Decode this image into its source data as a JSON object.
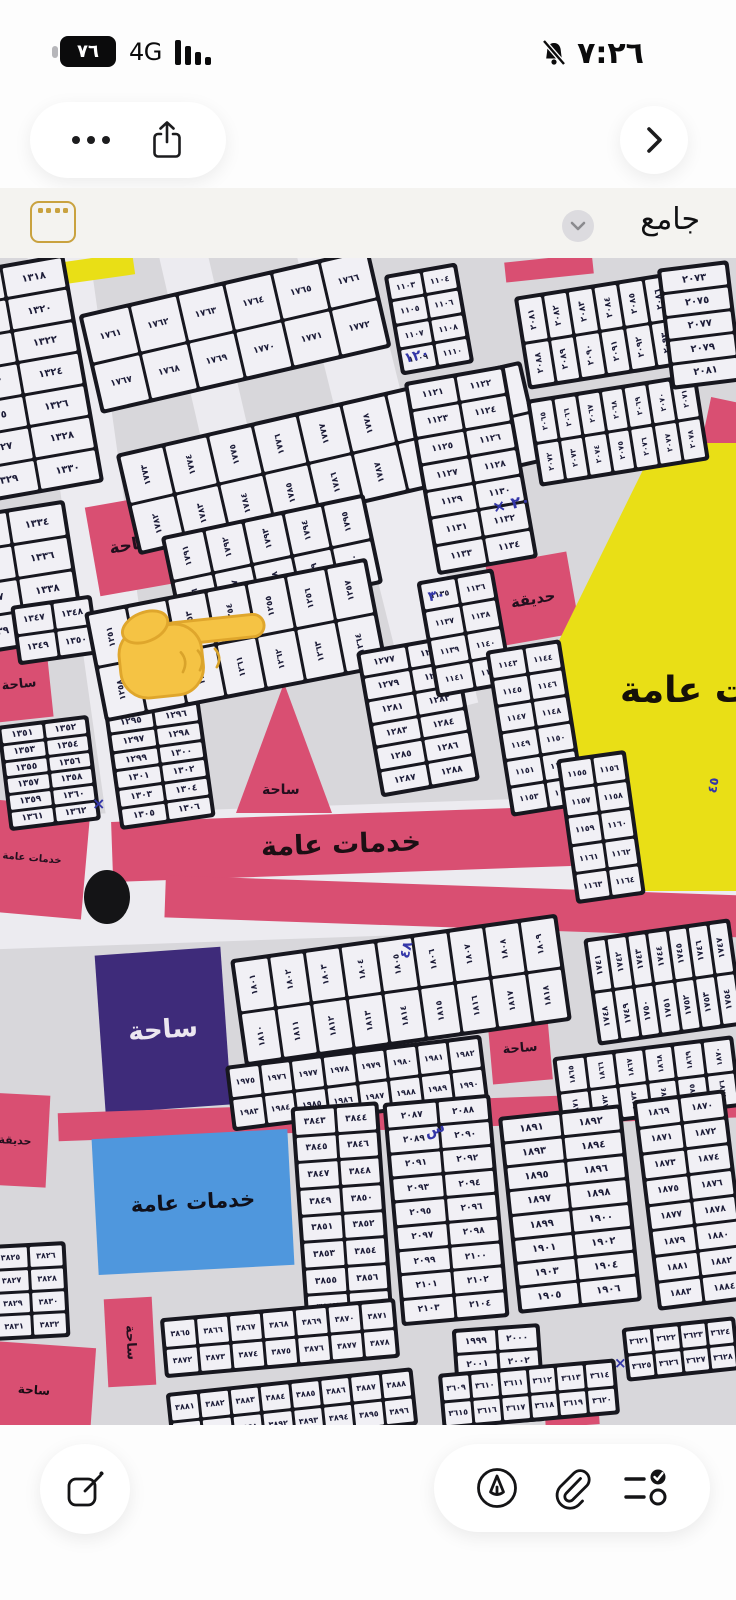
{
  "status_bar": {
    "battery_percent": "٧٦",
    "network": "4G",
    "time": "٧:٢٦"
  },
  "title_bar": {
    "title": "جامع"
  },
  "icons": {
    "more": "ellipsis",
    "share": "square-arrow-up",
    "back": "chevron-right",
    "thumbnail": "gold-card",
    "title_chevron": "chevron-down",
    "compose": "square-pencil",
    "markup": "pen-in-circle",
    "attach": "paperclip",
    "checklist": "list-check",
    "muted": "bell-slash"
  },
  "colors": {
    "pink": "#d94f72",
    "yellow": "#e9df16",
    "purple": "#3e2b7a",
    "blue": "#4f97dd",
    "paper": "#d8d7db",
    "road": "#ecebf0",
    "block": "#17171f",
    "cell": "#f1f0f5",
    "ink": "#1c1c38",
    "pen_blue": "#3336a8",
    "gold": "#c9a23f"
  },
  "map": {
    "roads": [
      {
        "x": 70,
        "y": -30,
        "w": 62,
        "h": 660,
        "r": -8
      },
      {
        "x": 352,
        "y": -30,
        "w": 68,
        "h": 490,
        "r": -14
      },
      {
        "x": -30,
        "y": 546,
        "w": 810,
        "h": 132,
        "r": -2
      },
      {
        "x": 190,
        "y": -20,
        "w": 48,
        "h": 300,
        "r": -13
      }
    ],
    "zones": [
      {
        "n": "yellow-wedge-top",
        "x": 52,
        "y": 0,
        "w": 82,
        "h": 22,
        "r": -8,
        "c": "#e9df16"
      },
      {
        "n": "pink-sliver-top",
        "x": 505,
        "y": 0,
        "w": 88,
        "h": 20,
        "r": -6,
        "c": "#d94f72"
      },
      {
        "n": "pink-sliver-right",
        "x": 706,
        "y": 142,
        "w": 34,
        "h": 46,
        "r": 12,
        "c": "#d94f72"
      },
      {
        "n": "zone-saha-square",
        "x": 92,
        "y": 242,
        "w": 80,
        "h": 90,
        "r": -10,
        "c": "#d94f72",
        "label": "ساحة",
        "fs": 17,
        "tc": "#230f1e"
      },
      {
        "n": "zone-saha-left",
        "x": -12,
        "y": 390,
        "w": 62,
        "h": 72,
        "r": -6,
        "c": "#d94f72",
        "label": "ساحة",
        "fs": 13,
        "tc": "#230f1e"
      },
      {
        "n": "zone-hadiqa-mid",
        "x": 492,
        "y": 300,
        "w": 82,
        "h": 82,
        "r": -10,
        "c": "#d94f72",
        "label": "حديقة",
        "fs": 15,
        "tc": "#230f1e"
      },
      {
        "n": "zone-yellow-services",
        "x": 546,
        "y": 185,
        "w": 190,
        "h": 448,
        "c": "#e9df16",
        "clip": "polygon(58% 0,100% 0,100% 100%,26% 100%,0 50%)",
        "label": "خدمات عامة",
        "fs": 36,
        "tc": "#151008",
        "lx": 74,
        "ly": 230
      },
      {
        "n": "zone-saha-triangle",
        "x": 236,
        "y": 425,
        "w": 96,
        "h": 130,
        "c": "#d94f72",
        "clip": "polygon(50% 0,100% 100%,0 100%)",
        "label": "ساحة",
        "fs": 14,
        "tc": "#230f1e",
        "lx": 26,
        "ly": 100
      },
      {
        "n": "zone-services-strip",
        "x": 112,
        "y": 556,
        "w": 458,
        "h": 60,
        "r": -2,
        "c": "#d94f72",
        "label": "خدمات عامة",
        "fs": 27,
        "tc": "#1c0f14"
      },
      {
        "n": "zone-road-strip2",
        "x": 165,
        "y": 628,
        "w": 610,
        "h": 42,
        "r": 2,
        "c": "#d94f72"
      },
      {
        "n": "zone-services-left-small",
        "x": -22,
        "y": 545,
        "w": 108,
        "h": 112,
        "r": 5,
        "c": "#d94f72",
        "label": "خدمات عامة",
        "fs": 10,
        "tc": "#230f1e"
      },
      {
        "n": "zone-saha-purple",
        "x": 100,
        "y": 693,
        "w": 126,
        "h": 158,
        "r": -4,
        "c": "#3e2b7a",
        "label": "ساحة",
        "fs": 26,
        "tc": "#ece7f0"
      },
      {
        "n": "zone-saha-small-square",
        "x": 490,
        "y": 756,
        "w": 60,
        "h": 68,
        "r": -5,
        "c": "#d94f72",
        "label": "ساحة",
        "fs": 13,
        "tc": "#230f1e"
      },
      {
        "n": "zone-pink-band-lower",
        "x": 58,
        "y": 843,
        "w": 700,
        "h": 28,
        "r": -2,
        "c": "#d94f72"
      },
      {
        "n": "zone-hadiqa-left",
        "x": -18,
        "y": 836,
        "w": 66,
        "h": 92,
        "r": 3,
        "c": "#d94f72",
        "label": "حديقة",
        "fs": 11,
        "tc": "#230f1e"
      },
      {
        "n": "zone-services-blue",
        "x": 95,
        "y": 876,
        "w": 196,
        "h": 136,
        "r": -3,
        "c": "#4f97dd",
        "label": "خدمات عامة",
        "fs": 21,
        "tc": "#10101a"
      },
      {
        "n": "zone-saha-vrect",
        "x": 106,
        "y": 1040,
        "w": 48,
        "h": 88,
        "r": -3,
        "c": "#d94f72",
        "label": "ساحة",
        "fs": 13,
        "tc": "#230f1e",
        "vert": true
      },
      {
        "n": "zone-pink-bottomleft",
        "x": -25,
        "y": 1086,
        "w": 118,
        "h": 92,
        "r": 4,
        "c": "#d94f72",
        "label": "ساحة",
        "fs": 12,
        "tc": "#1a0c14"
      },
      {
        "n": "zone-hadiqa-bottomright",
        "x": 544,
        "y": 1118,
        "w": 54,
        "h": 50,
        "r": -4,
        "c": "#d94f72",
        "label": "حديقة",
        "fs": 9,
        "tc": "#230f1e"
      }
    ],
    "blocks": [
      {
        "x": -45,
        "y": 5,
        "w": 130,
        "h": 232,
        "r": -10,
        "rows": 7,
        "cols": 2,
        "start": 1317
      },
      {
        "x": -42,
        "y": 250,
        "w": 118,
        "h": 140,
        "r": -9,
        "rows": 4,
        "cols": 2,
        "start": 1333
      },
      {
        "x": 14,
        "y": 342,
        "w": 82,
        "h": 60,
        "r": -8,
        "rows": 2,
        "cols": 2,
        "start": 1347
      },
      {
        "x": 3,
        "y": 462,
        "w": 92,
        "h": 106,
        "r": -7,
        "rows": 6,
        "cols": 2,
        "start": 1351
      },
      {
        "x": 112,
        "y": 448,
        "w": 96,
        "h": 118,
        "r": -8,
        "rows": 6,
        "cols": 2,
        "start": 1295
      },
      {
        "x": 86,
        "y": 22,
        "w": 298,
        "h": 102,
        "r": -13,
        "rows": 2,
        "cols": 6,
        "start": 1761
      },
      {
        "x": 122,
        "y": 148,
        "w": 416,
        "h": 104,
        "r": -13,
        "rows": 2,
        "cols": 9,
        "start": 1773
      },
      {
        "x": 168,
        "y": 256,
        "w": 208,
        "h": 92,
        "r": -12,
        "rows": 2,
        "cols": 5,
        "start": 1791
      },
      {
        "x": 92,
        "y": 326,
        "w": 288,
        "h": 112,
        "r": -11,
        "rows": 2,
        "cols": 7,
        "start": 1251
      },
      {
        "x": 368,
        "y": 384,
        "w": 100,
        "h": 148,
        "r": -10,
        "rows": 6,
        "cols": 2,
        "start": 1277
      },
      {
        "x": 392,
        "y": 10,
        "w": 74,
        "h": 102,
        "r": -10,
        "rows": 4,
        "cols": 2,
        "start": 1103
      },
      {
        "x": 420,
        "y": 114,
        "w": 102,
        "h": 196,
        "r": -10,
        "rows": 7,
        "cols": 2,
        "start": 1121
      },
      {
        "x": 520,
        "y": 24,
        "w": 184,
        "h": 94,
        "r": -9,
        "rows": 2,
        "cols": 7,
        "start": 2081
      },
      {
        "x": 532,
        "y": 128,
        "w": 172,
        "h": 88,
        "r": -9,
        "rows": 2,
        "cols": 7,
        "start": 2065
      },
      {
        "x": 664,
        "y": 6,
        "w": 72,
        "h": 122,
        "r": -7,
        "rows": 5,
        "cols": 1,
        "start": 2073,
        "step": 2
      },
      {
        "x": 426,
        "y": 316,
        "w": 78,
        "h": 118,
        "r": -10,
        "rows": 4,
        "cols": 2,
        "start": 1135
      },
      {
        "x": 498,
        "y": 386,
        "w": 76,
        "h": 168,
        "r": -9,
        "rows": 6,
        "cols": 2,
        "start": 1143
      },
      {
        "x": 566,
        "y": 496,
        "w": 70,
        "h": 146,
        "r": -8,
        "rows": 5,
        "cols": 2,
        "start": 1155
      },
      {
        "x": 236,
        "y": 678,
        "w": 330,
        "h": 108,
        "r": -8,
        "rows": 2,
        "cols": 9,
        "start": 1801
      },
      {
        "x": 590,
        "y": 670,
        "w": 148,
        "h": 108,
        "r": -8,
        "rows": 2,
        "cols": 7,
        "start": 1741
      },
      {
        "x": 228,
        "y": 792,
        "w": 258,
        "h": 66,
        "r": -7,
        "rows": 2,
        "cols": 8,
        "start": 1975
      },
      {
        "x": 556,
        "y": 788,
        "w": 182,
        "h": 72,
        "r": -7,
        "rows": 2,
        "cols": 6,
        "start": 1865
      },
      {
        "x": 298,
        "y": 846,
        "w": 88,
        "h": 218,
        "r": -4,
        "rows": 8,
        "cols": 2,
        "start": 3843
      },
      {
        "x": 392,
        "y": 840,
        "w": 108,
        "h": 224,
        "r": -5,
        "rows": 9,
        "cols": 2,
        "start": 2087
      },
      {
        "x": 508,
        "y": 852,
        "w": 124,
        "h": 198,
        "r": -6,
        "rows": 8,
        "cols": 2,
        "start": 1891
      },
      {
        "x": 645,
        "y": 836,
        "w": 93,
        "h": 212,
        "r": -7,
        "rows": 8,
        "cols": 2,
        "start": 1869
      },
      {
        "x": 455,
        "y": 1068,
        "w": 88,
        "h": 98,
        "r": -4,
        "rows": 4,
        "cols": 2,
        "start": 1999
      },
      {
        "x": -8,
        "y": 985,
        "w": 76,
        "h": 96,
        "r": -3,
        "rows": 4,
        "cols": 2,
        "start": 3825
      },
      {
        "x": 162,
        "y": 1050,
        "w": 236,
        "h": 60,
        "r": -5,
        "rows": 2,
        "cols": 7,
        "start": 3865
      },
      {
        "x": 168,
        "y": 1122,
        "w": 248,
        "h": 58,
        "r": -6,
        "rows": 2,
        "cols": 8,
        "start": 3881
      },
      {
        "x": 440,
        "y": 1108,
        "w": 178,
        "h": 56,
        "r": -5,
        "rows": 2,
        "cols": 6,
        "start": 3609
      },
      {
        "x": 624,
        "y": 1064,
        "w": 114,
        "h": 54,
        "r": -6,
        "rows": 2,
        "cols": 4,
        "start": 3621
      }
    ],
    "annotations": [
      {
        "t": "× ٢٠",
        "x": 492,
        "y": 236,
        "r": -12,
        "fs": 16
      },
      {
        "t": "١٢٠",
        "x": 404,
        "y": 90,
        "r": -14,
        "fs": 14
      },
      {
        "t": "٣٠",
        "x": 428,
        "y": 330,
        "r": -10,
        "fs": 14
      },
      {
        "t": "×",
        "x": 92,
        "y": 536,
        "r": 0,
        "fs": 16
      },
      {
        "t": "٤٨",
        "x": 398,
        "y": 684,
        "r": -75,
        "fs": 14
      },
      {
        "t": "٤٥",
        "x": 706,
        "y": 520,
        "r": -80,
        "fs": 13
      },
      {
        "t": "س",
        "x": 424,
        "y": 862,
        "r": -20,
        "fs": 15
      },
      {
        "t": "×",
        "x": 614,
        "y": 1096,
        "r": 0,
        "fs": 15
      }
    ],
    "roundabout": {
      "x": 84,
      "y": 612,
      "w": 46,
      "h": 54
    },
    "pointer": {
      "x": 112,
      "y": 326,
      "w": 158,
      "h": 128,
      "r": -6
    }
  }
}
